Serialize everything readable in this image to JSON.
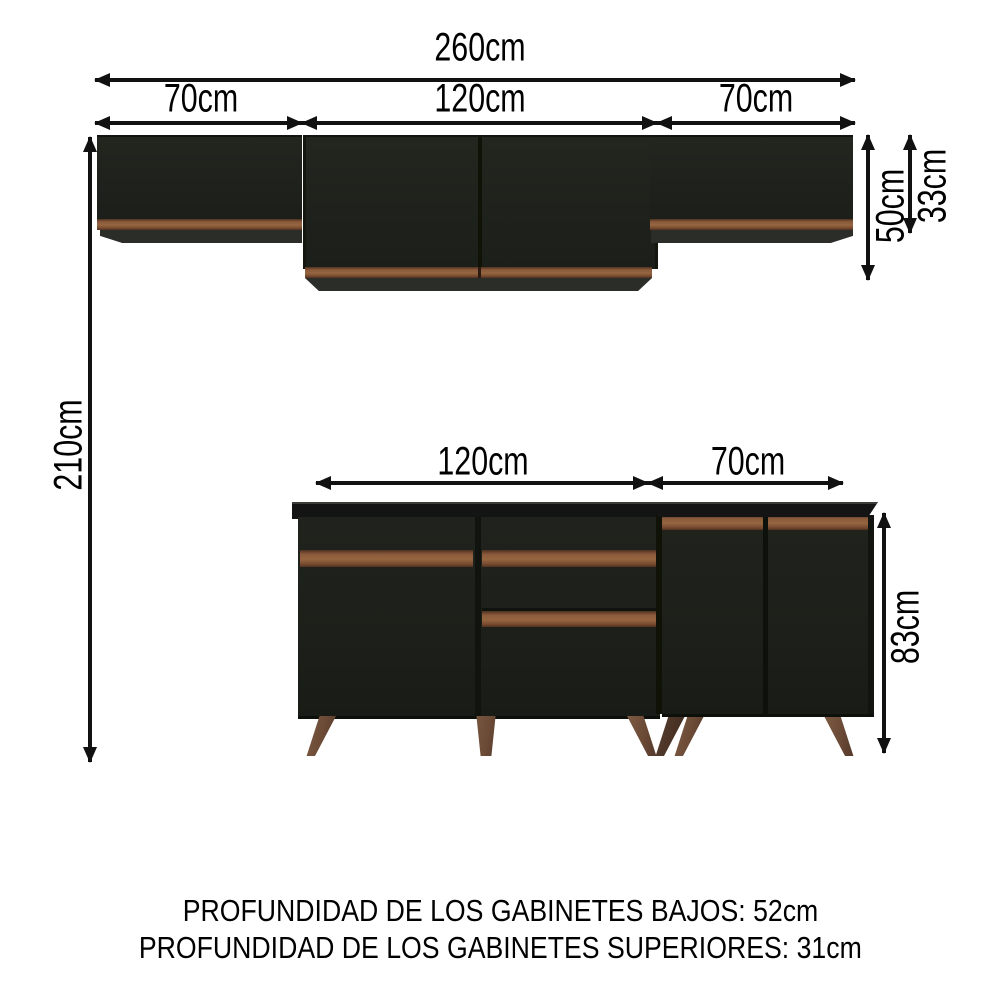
{
  "diagram": {
    "type": "kitchen-cabinet-dimension-diagram",
    "dims": {
      "total_width": "260cm",
      "upper_left_width": "70cm",
      "upper_center_width": "120cm",
      "upper_right_width": "70cm",
      "total_height": "210cm",
      "upper_center_height": "50cm",
      "upper_side_height": "33cm",
      "lower_left_width": "120cm",
      "lower_right_width": "70cm",
      "lower_height": "83cm"
    },
    "footer": {
      "line1": "PROFUNDIDAD DE LOS GABINETES BAJOS: 52cm",
      "line2": "PROFUNDIDAD DE LOS GABINETES SUPERIORES: 31cm"
    },
    "colors": {
      "background": "#ffffff",
      "dimension_ink": "#111111",
      "cabinet_black": "#1f221c",
      "countertop_black": "#141414",
      "trim_brown": "#8a5a3c",
      "base_dark": "#2b2d29",
      "leg_brown": "#6b4a36"
    }
  }
}
